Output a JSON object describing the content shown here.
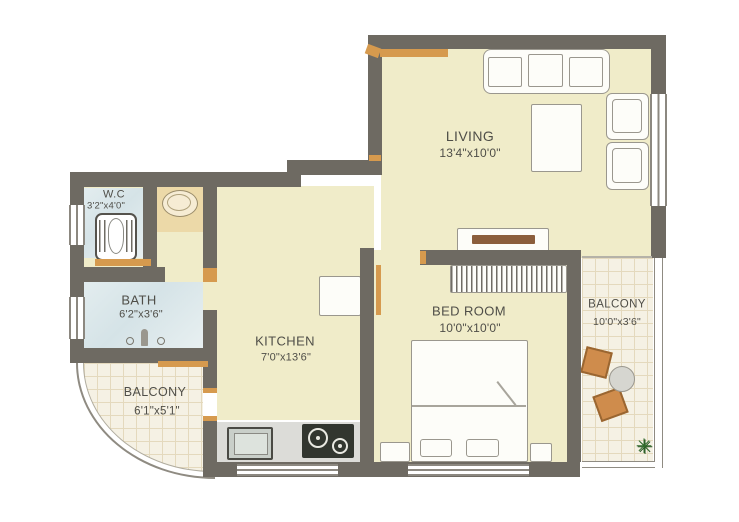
{
  "plan": {
    "type": "apartment-floor-plan",
    "rooms": [
      {
        "name": "LIVING",
        "dims": "13'4\"x10'0\""
      },
      {
        "name": "W.C",
        "dims": "3'2\"x4'0\""
      },
      {
        "name": "BATH",
        "dims": "6'2\"x3'6\""
      },
      {
        "name": "KITCHEN",
        "dims": "7'0\"x13'6\""
      },
      {
        "name": "BED ROOM",
        "dims": "10'0\"x10'0\""
      },
      {
        "name": "BALCONY",
        "dims": "10'0\"x3'6\""
      },
      {
        "name": "BALCONY",
        "dims": "6'1\"x5'1\""
      }
    ],
    "colors": {
      "wall": "#6e6a62",
      "floor": "#f0ecc9",
      "wet_floor": "#dce8ea",
      "balcony_tile": "#f5f1e4",
      "door_wood": "#d69a4e",
      "furniture_outline": "#9a978e",
      "stove": "#32362f",
      "balcony_chair": "#cf8c4c",
      "plant": "#2f6b2a",
      "text": "#4f4e48"
    },
    "furniture": [
      "sofa",
      "coffee-table",
      "armchair",
      "armchair",
      "tv-unit",
      "wardrobe",
      "double-bed",
      "pillow",
      "pillow",
      "bedside-table",
      "bedside-table",
      "refrigerator",
      "kitchen-counter",
      "sink",
      "stove",
      "toilet",
      "wash-basin",
      "shower",
      "balcony-chair",
      "balcony-chair",
      "balcony-table",
      "plant"
    ]
  }
}
